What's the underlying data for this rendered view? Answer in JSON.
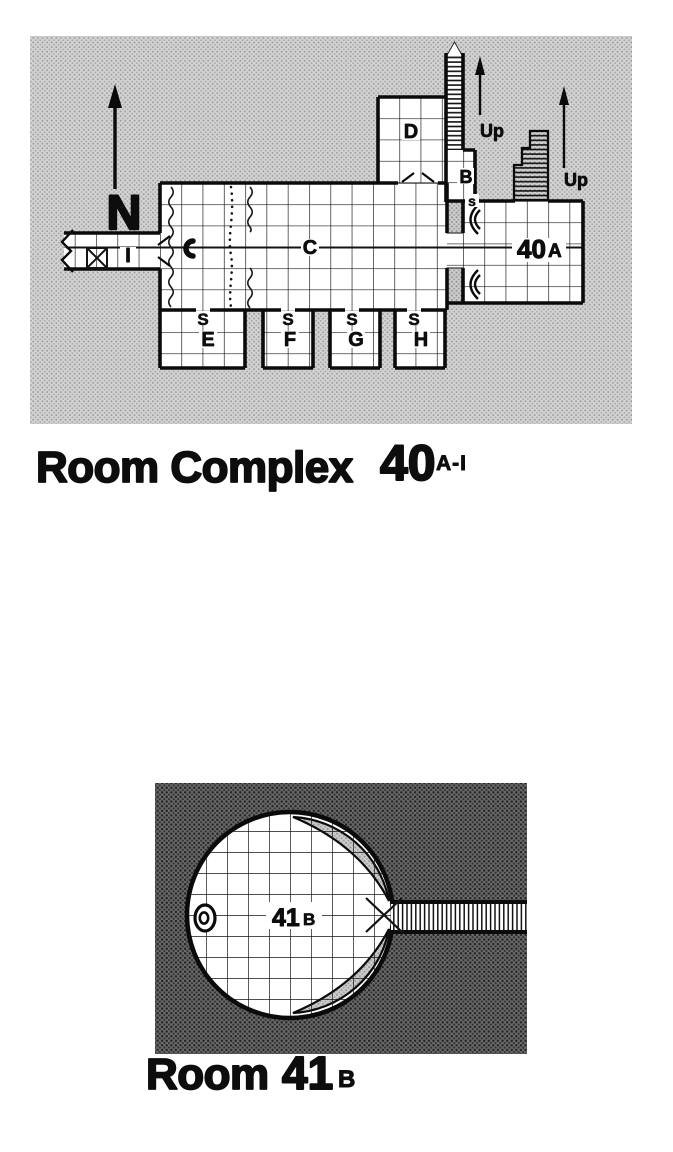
{
  "map1": {
    "title": {
      "main": "Room Complex",
      "number": "40",
      "range": "A-I"
    },
    "compass": "N",
    "up_label": "Up",
    "rooms": {
      "c": "C",
      "d": "D",
      "b": "B",
      "i": "I",
      "e": "E",
      "f": "F",
      "g": "G",
      "h": "H"
    },
    "room_a": {
      "number": "40",
      "letter": "A"
    },
    "secret_door": "S",
    "secret_door_small": "s"
  },
  "map2": {
    "title": {
      "main": "Room",
      "number": "41",
      "sub": "B"
    },
    "room_label": {
      "number": "41",
      "letter": "B"
    }
  },
  "colors": {
    "ink": "#0d0d0d",
    "paper": "#ffffff",
    "light_halftone": "#d3d3d3",
    "shaded_halftone": "#cccccc",
    "dark_halftone": "#4f4f4f"
  }
}
